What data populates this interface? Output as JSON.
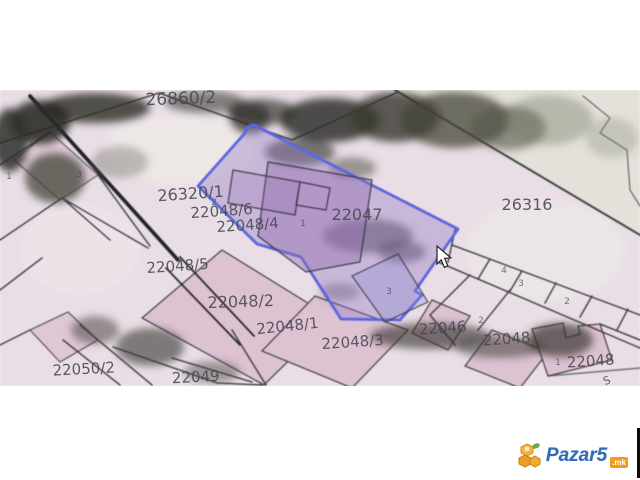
{
  "page": {
    "background": "#ffffff",
    "kind": "cadastral map screenshot"
  },
  "map": {
    "base_color": "#e9dee6",
    "line_color": "#44444c",
    "building_color": "#ddc2d2",
    "selected_parcel": {
      "id": "22047",
      "outline_color": "#5b67dd",
      "fill_color": "rgba(148,122,196,0.38)"
    },
    "labels": [
      {
        "text": "26860/2",
        "x": 181,
        "y": 104,
        "size": 17,
        "rot": -2
      },
      {
        "text": "26320/1",
        "x": 191,
        "y": 199,
        "size": 16,
        "rot": -4
      },
      {
        "text": "22048/6",
        "x": 222,
        "y": 216,
        "size": 15,
        "rot": -4
      },
      {
        "text": "22048/4",
        "x": 248,
        "y": 230,
        "size": 15,
        "rot": -4
      },
      {
        "text": "22047",
        "x": 357,
        "y": 220,
        "size": 16,
        "rot": 0
      },
      {
        "text": "26316",
        "x": 527,
        "y": 210,
        "size": 16,
        "rot": 0
      },
      {
        "text": "22048/5",
        "x": 178,
        "y": 271,
        "size": 15,
        "rot": -4
      },
      {
        "text": "22048/2",
        "x": 241,
        "y": 307,
        "size": 16,
        "rot": -2
      },
      {
        "text": "22048/1",
        "x": 288,
        "y": 331,
        "size": 15,
        "rot": -6
      },
      {
        "text": "22048/3",
        "x": 353,
        "y": 347,
        "size": 15,
        "rot": -4
      },
      {
        "text": "22046",
        "x": 443,
        "y": 333,
        "size": 15,
        "rot": -4
      },
      {
        "text": "22048",
        "x": 507,
        "y": 344,
        "size": 15,
        "rot": -4
      },
      {
        "text": "22048",
        "x": 591,
        "y": 366,
        "size": 15,
        "rot": -4
      },
      {
        "text": "22050/2",
        "x": 84,
        "y": 374,
        "size": 15,
        "rot": -3
      },
      {
        "text": "22049",
        "x": 196,
        "y": 382,
        "size": 15,
        "rot": -3
      },
      {
        "text": "S",
        "x": 608,
        "y": 384,
        "size": 11,
        "rot": -20
      }
    ],
    "small_numbers": [
      {
        "text": "1",
        "x": 303,
        "y": 226
      },
      {
        "text": "2",
        "x": 214,
        "y": 205
      },
      {
        "text": "3",
        "x": 389,
        "y": 294
      },
      {
        "text": "4",
        "x": 504,
        "y": 273
      },
      {
        "text": "3",
        "x": 521,
        "y": 286
      },
      {
        "text": "2",
        "x": 567,
        "y": 304
      },
      {
        "text": "2",
        "x": 481,
        "y": 323
      },
      {
        "text": "1",
        "x": 558,
        "y": 365
      },
      {
        "text": "1",
        "x": 31,
        "y": 146
      },
      {
        "text": "1",
        "x": 9,
        "y": 179
      },
      {
        "text": "3",
        "x": 79,
        "y": 177
      }
    ]
  },
  "cursor": {
    "x": 437,
    "y": 247,
    "style": "arrow"
  },
  "logo": {
    "brand": "Pazar5",
    "tld": ".mk",
    "brand_color": "#2f6db5",
    "tld_bg": "#f29a1f",
    "icon": "honeycomb-bee-icon"
  }
}
